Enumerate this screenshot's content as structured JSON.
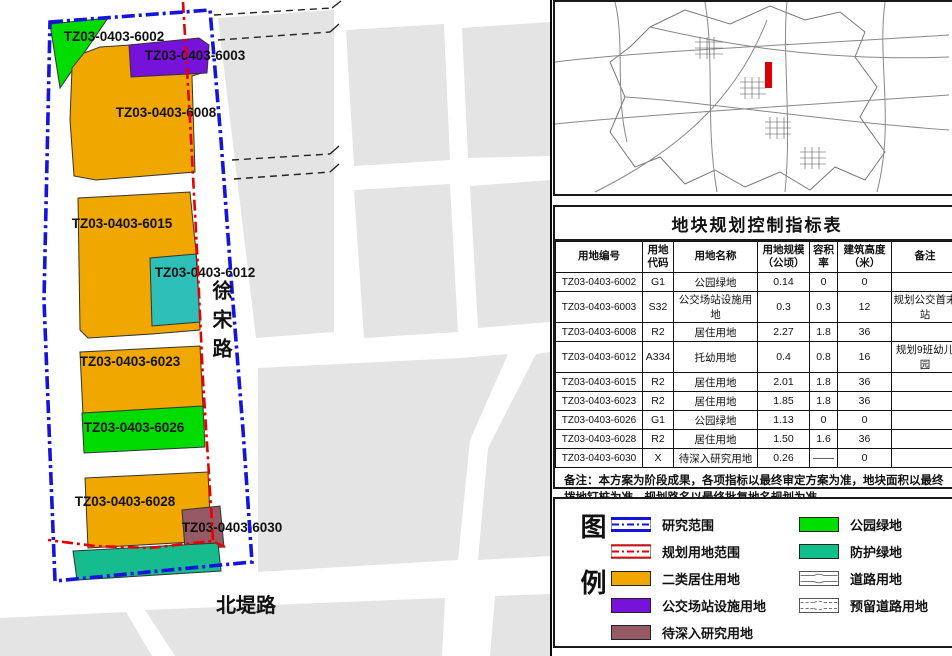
{
  "colors": {
    "research_boundary": "#1414DC",
    "planning_boundary": "#E60000",
    "residential": "#F0A800",
    "park_green": "#00E000",
    "protective_green": "#10C08A",
    "transit_purple": "#7612D9",
    "study_maroon": "#955A63",
    "kindergarten_teal": "#2EC0B8",
    "map_block_gray": "#E4E4E4",
    "locator_marker": "#DD0000"
  },
  "map": {
    "road_labels": {
      "xusong": "徐宋路",
      "beidi": "北堤路"
    },
    "parcels": [
      {
        "id": "TZ03-0403-6002",
        "color": "#00DC00",
        "shape": "50,24 108,18 60,88",
        "lx": 114,
        "ly": 41
      },
      {
        "id": "TZ03-0403-6008",
        "color": "#F0A800",
        "shape": "116,46 198,40 205,72 192,76 195,172 96,180 74,176 70,120 72,68 84,53 100,47",
        "lx": 166,
        "ly": 117
      },
      {
        "id": "TZ03-0403-6003",
        "color": "#7612D9",
        "shape": "129,45 199,38 209,45 207,73 131,77",
        "lx": 195,
        "ly": 60
      },
      {
        "id": "TZ03-0403-6015",
        "color": "#F0A800",
        "shape": "78,198 190,192 197,262 200,330 152,334 88,338 80,330",
        "lx": 122,
        "ly": 228
      },
      {
        "id": "TZ03-0403-6012",
        "color": "#2EC0B8",
        "shape": "150,258 196,254 200,322 152,326",
        "lx": 205,
        "ly": 277
      },
      {
        "id": "TZ03-0403-6023",
        "color": "#F0A800",
        "shape": "80,352 200,346 203,408 83,415",
        "lx": 130,
        "ly": 366
      },
      {
        "id": "TZ03-0403-6026",
        "color": "#00DC00",
        "shape": "82,413 203,406 205,447 84,453",
        "lx": 134,
        "ly": 432
      },
      {
        "id": "TZ03-0403-6028",
        "color": "#F0A800",
        "shape": "85,478 208,472 211,541 88,548",
        "lx": 125,
        "ly": 506
      },
      {
        "id": "TZ03-0403-6030",
        "color": "#955A63",
        "shape": "182,510 220,506 224,547 185,549",
        "lx": 232,
        "ly": 532
      },
      {
        "id": "",
        "color": "#16BC8E",
        "shape": "73,551 218,543 221,571 77,580",
        "lx": 0,
        "ly": 0
      }
    ]
  },
  "table": {
    "title": "地块规划控制指标表",
    "headers": [
      "用地编号",
      "用地\n代码",
      "用地名称",
      "用地规模\n（公顷）",
      "容积\n率",
      "建筑高度\n（米）",
      "备注"
    ],
    "rows": [
      [
        "TZ03-0403-6002",
        "G1",
        "公园绿地",
        "0.14",
        "0",
        "0",
        ""
      ],
      [
        "TZ03-0403-6003",
        "S32",
        "公交场站设施用地",
        "0.3",
        "0.3",
        "12",
        "规划公交首末站"
      ],
      [
        "TZ03-0403-6008",
        "R2",
        "居住用地",
        "2.27",
        "1.8",
        "36",
        ""
      ],
      [
        "TZ03-0403-6012",
        "A334",
        "托幼用地",
        "0.4",
        "0.8",
        "16",
        "规划9班幼儿园"
      ],
      [
        "TZ03-0403-6015",
        "R2",
        "居住用地",
        "2.01",
        "1.8",
        "36",
        ""
      ],
      [
        "TZ03-0403-6023",
        "R2",
        "居住用地",
        "1.85",
        "1.8",
        "36",
        ""
      ],
      [
        "TZ03-0403-6026",
        "G1",
        "公园绿地",
        "1.13",
        "0",
        "0",
        ""
      ],
      [
        "TZ03-0403-6028",
        "R2",
        "居住用地",
        "1.50",
        "1.6",
        "36",
        ""
      ],
      [
        "TZ03-0403-6030",
        "X",
        "待深入研究用地",
        "0.26",
        "——",
        "0",
        ""
      ]
    ],
    "note": "备注：本方案为阶段成果，各项指标以最终审定方案为准，地块面积以最终拨地钉桩为准，规划路名以最终批复地名规划为准。"
  },
  "legend": {
    "title": "图例",
    "left": [
      {
        "label": "研究范围",
        "type": "research",
        "color": "#1414DC"
      },
      {
        "label": "规划用地范围",
        "type": "planning",
        "color": "#E60000"
      },
      {
        "label": "二类居住用地",
        "type": "fill",
        "color": "#F0A800"
      },
      {
        "label": "公交场站设施用地",
        "type": "fill",
        "color": "#7612D9"
      },
      {
        "label": "待深入研究用地",
        "type": "fill",
        "color": "#955A63"
      }
    ],
    "right": [
      {
        "label": "公园绿地",
        "type": "fill",
        "color": "#00E000"
      },
      {
        "label": "防护绿地",
        "type": "fill",
        "color": "#10C08A"
      },
      {
        "label": "道路用地",
        "type": "road",
        "color": "#777777"
      },
      {
        "label": "预留道路用地",
        "type": "road-reserved",
        "color": "#777777"
      }
    ]
  }
}
